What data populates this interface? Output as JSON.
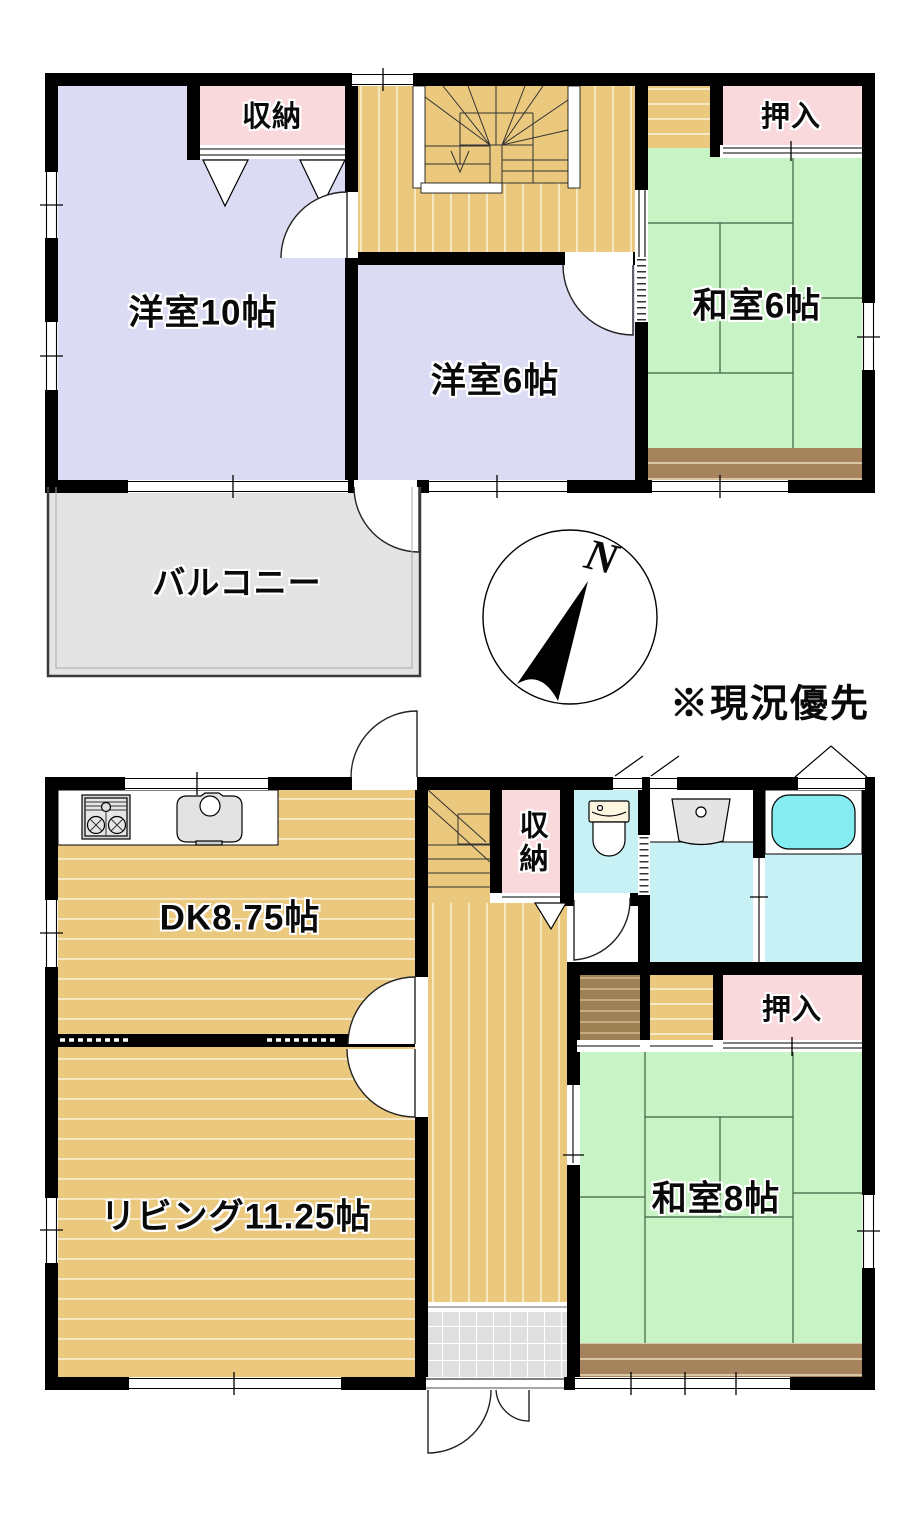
{
  "floor2": {
    "yoshitsu10": "洋室10帖",
    "yoshitsu6": "洋室6帖",
    "washitsu6": "和室6帖",
    "shuno": "収納",
    "oshiire": "押入",
    "balcony": "バルコニー"
  },
  "floor1": {
    "dk": "DK8.75帖",
    "living": "リビング11.25帖",
    "washitsu8": "和室8帖",
    "shuno": "収納",
    "oshiire": "押入"
  },
  "compass": {
    "north": "N"
  },
  "annotation": "※現況優先",
  "colors": {
    "wall": "#000000",
    "western_room": "#dcdbf4",
    "tatami_room": "#c8f3c5",
    "closet": "#fad9dd",
    "wet_area": "#c7f1f5",
    "bathtub": "#85ecf2",
    "wood_floor": "#eac97e",
    "engawa_wood": "#a5835c",
    "dark_wood": "#9d8054",
    "balcony": "#e4e4e4",
    "entrance_tile": "#dfdfdf"
  }
}
